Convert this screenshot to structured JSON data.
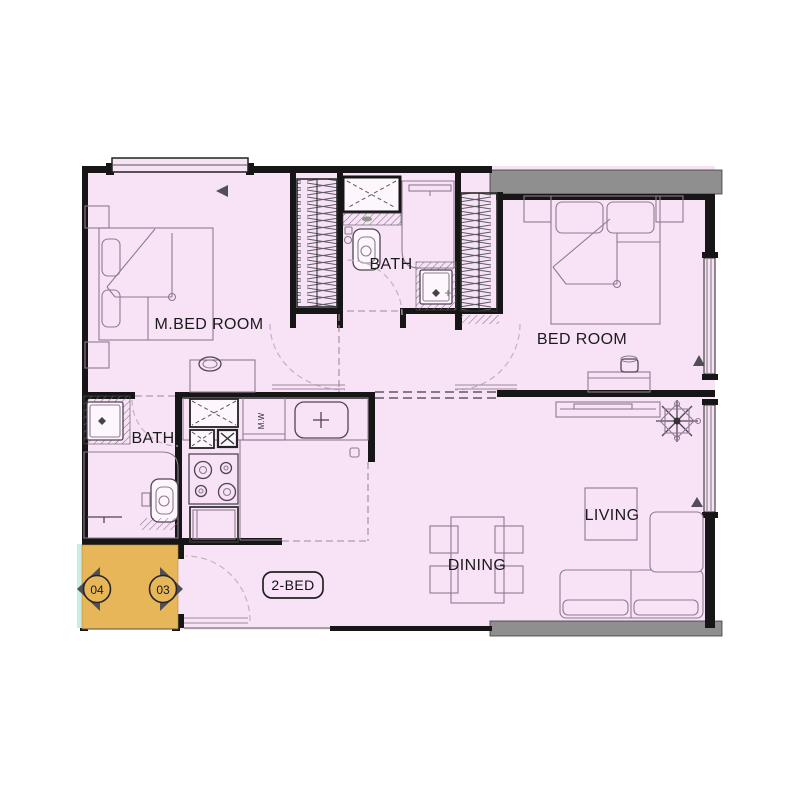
{
  "plan": {
    "unit_type_label": "2-BED",
    "rooms": [
      {
        "label": "M.BED ROOM"
      },
      {
        "label": "BATH"
      },
      {
        "label": "BED ROOM"
      },
      {
        "label": "BATH"
      },
      {
        "label": "DINING"
      },
      {
        "label": "LIVING"
      }
    ],
    "unit_markers": [
      {
        "label": "04",
        "points": "left"
      },
      {
        "label": "03",
        "points": "right"
      }
    ],
    "kitchen": {
      "microwave_label": "M.W"
    },
    "colors": {
      "floor": "#f8e2f6",
      "lobby_highlight": "#e7b659",
      "wall": "#161616",
      "slab": "#8f8f8f",
      "teal_accent": "#c9ece4",
      "marker_triangle": "#4f4f55"
    }
  }
}
